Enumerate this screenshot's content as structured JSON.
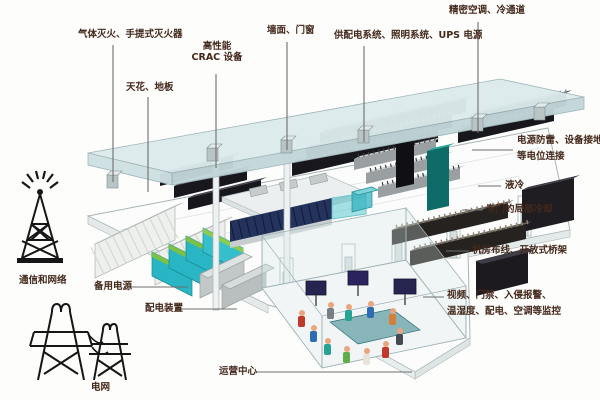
{
  "diagram": {
    "subject": "data-center-machine-room-annotated-isometric",
    "labels": {
      "fire": "气体灭火、手提式灭火器",
      "ceiling_floor": "天花、地板",
      "crac_line1": "高性能",
      "crac_line2": "CRAC 设备",
      "wall_door": "墙面、门窗",
      "power_lighting_ups": "供配电系统、照明系统、UPS 电源",
      "precision_ac": "精密空调、冷通道",
      "surge_line1": "电源防雷、设备接地、",
      "surge_line2": "等电位连接",
      "liquid_cooling": "液冷",
      "local_cooling": "专门的局部冷却",
      "cabling": "机房布线、开放式桥架",
      "monitoring_line1": "视频、门禁、入侵报警、",
      "monitoring_line2": "温湿度、配电、空调等监控",
      "comms": "通信和网络",
      "backup_power": "备用电源",
      "power_distribution": "配电装置",
      "ops_center": "运营中心",
      "grid": "电网"
    },
    "icons": {
      "left_top": "radio-tower",
      "left_bottom": "power-pylons"
    },
    "colors": {
      "label_text": "#44281b",
      "leader_line": "#6e6e6e",
      "ceiling": "#dcebed",
      "rack_dark": "#17171d",
      "rack_gray": "#9aa0a2",
      "pod_navy": "#24335c",
      "battery_teal": "#2ab5c4",
      "battery_green": "#7cc143",
      "monitor_navy": "#262450"
    }
  }
}
